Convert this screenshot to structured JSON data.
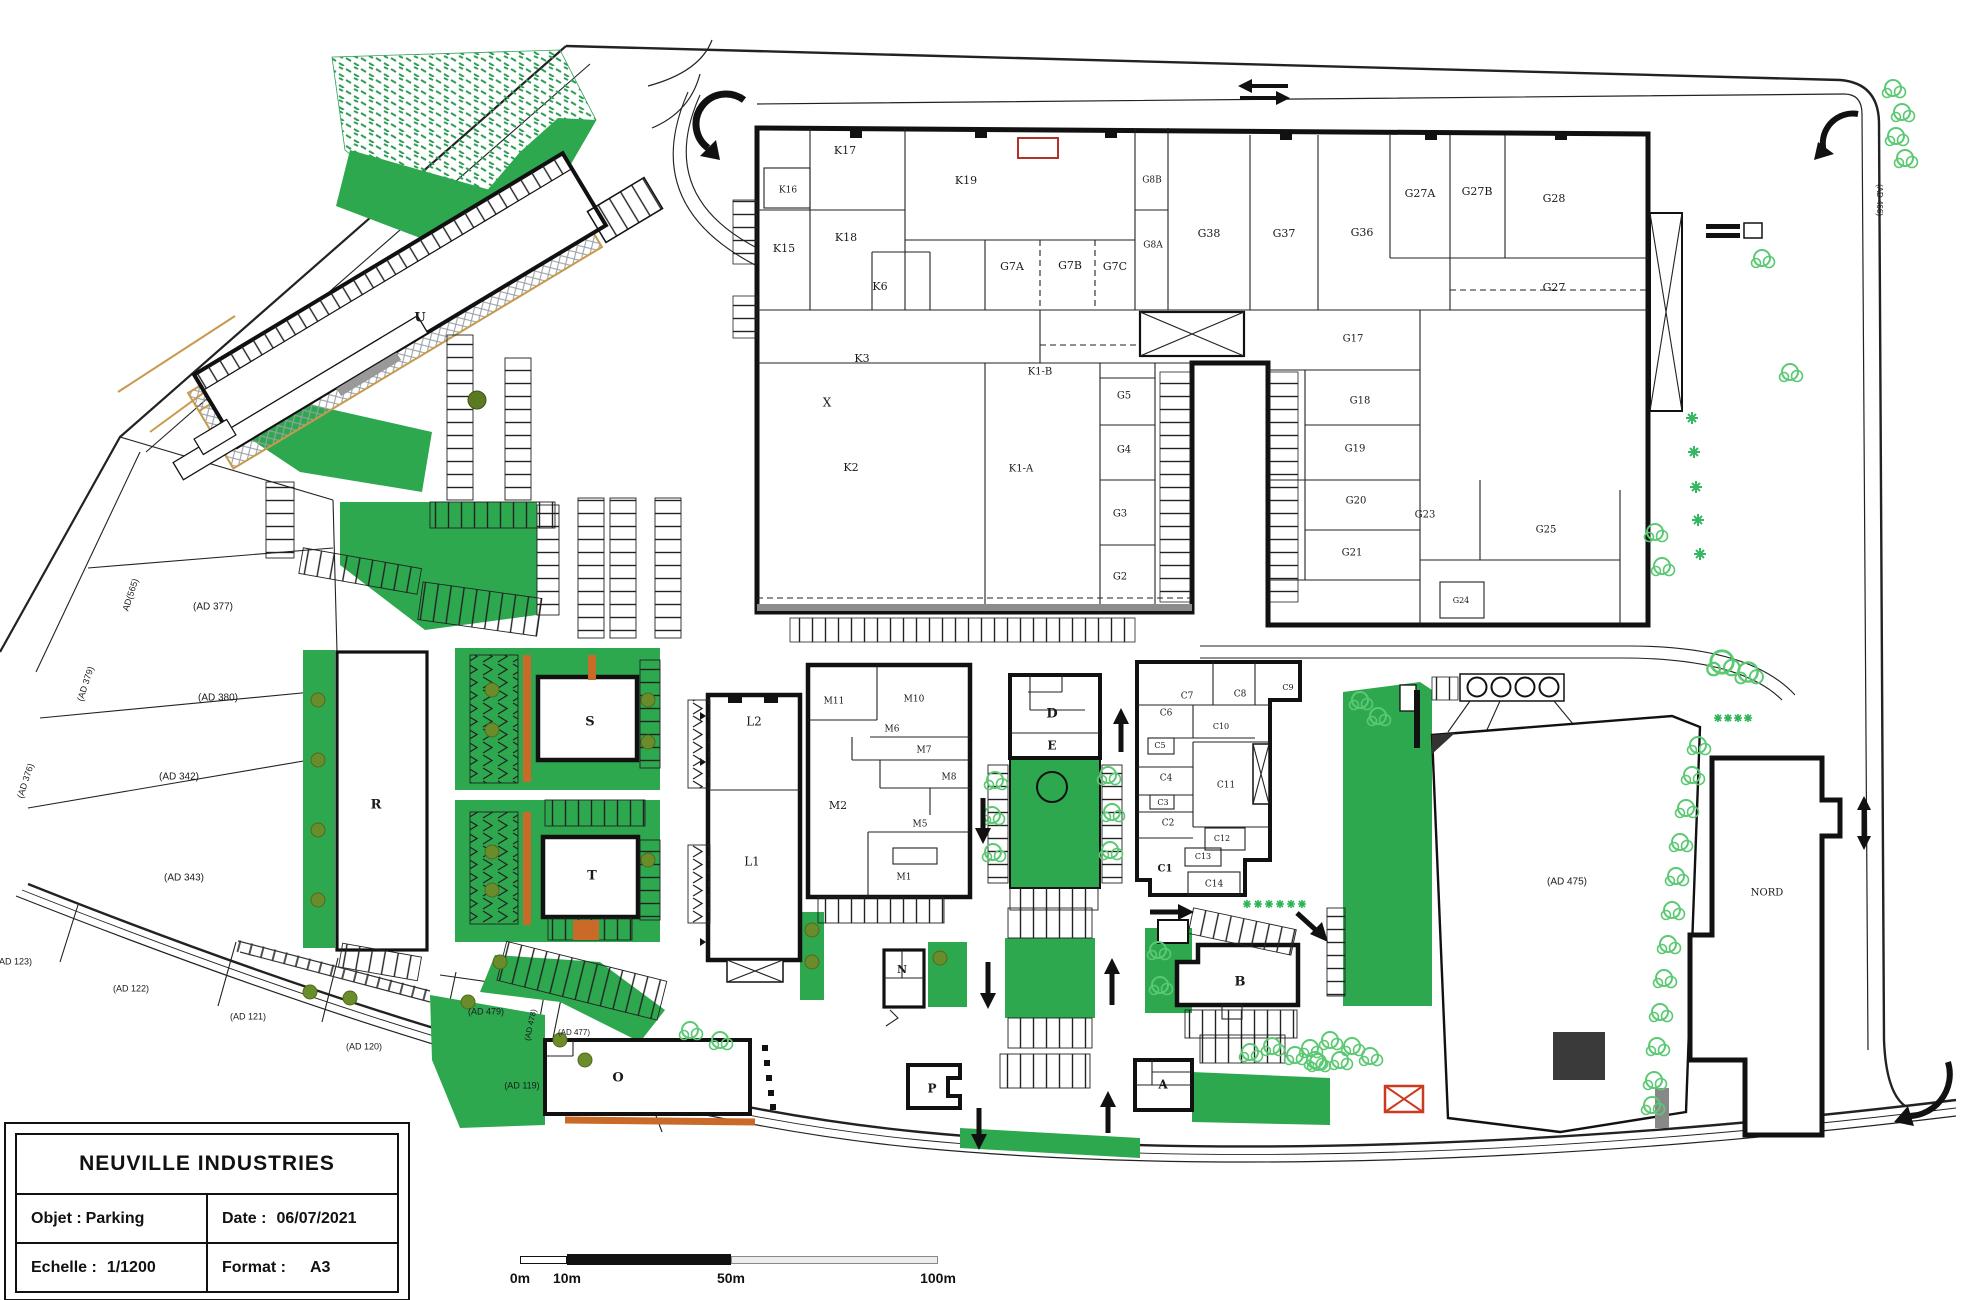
{
  "title_block": {
    "title": "NEUVILLE INDUSTRIES",
    "objet_label": "Objet :",
    "objet_value": "Parking",
    "date_label": "Date :",
    "date_value": "06/07/2021",
    "echelle_label": "Echelle :",
    "echelle_value": "1/1200",
    "format_label": "Format :",
    "format_value": "A3"
  },
  "scale_bar": {
    "labels": [
      "0m",
      "10m",
      "50m",
      "100m"
    ]
  },
  "colors": {
    "green_solid": "#2EA84F",
    "green_light": "#5bc973",
    "green_hatch": "#2f9e55",
    "olive": "#6b8c2a",
    "orange": "#c96a28",
    "tan": "#c79a4b",
    "red": "#b3322a",
    "wall": "#111111"
  },
  "plan": {
    "labels": [
      {
        "id": "k17",
        "t": "K17",
        "x": 845,
        "y": 151
      },
      {
        "id": "k16",
        "t": "K16",
        "x": 788,
        "y": 190,
        "s": 9
      },
      {
        "id": "k15",
        "t": "K15",
        "x": 784,
        "y": 249
      },
      {
        "id": "k18",
        "t": "K18",
        "x": 846,
        "y": 238
      },
      {
        "id": "k6",
        "t": "K6",
        "x": 880,
        "y": 287
      },
      {
        "id": "k19",
        "t": "K19",
        "x": 966,
        "y": 181
      },
      {
        "id": "g8b",
        "t": "G8B",
        "x": 1152,
        "y": 180,
        "s": 9
      },
      {
        "id": "g8a",
        "t": "G8A",
        "x": 1153,
        "y": 245,
        "s": 9
      },
      {
        "id": "g7a",
        "t": "G7A",
        "x": 1012,
        "y": 267
      },
      {
        "id": "g7b",
        "t": "G7B",
        "x": 1070,
        "y": 266
      },
      {
        "id": "g7c",
        "t": "G7C",
        "x": 1115,
        "y": 267
      },
      {
        "id": "g38",
        "t": "G38",
        "x": 1209,
        "y": 234
      },
      {
        "id": "g37",
        "t": "G37",
        "x": 1284,
        "y": 234
      },
      {
        "id": "g36",
        "t": "G36",
        "x": 1362,
        "y": 233
      },
      {
        "id": "g27a",
        "t": "G27A",
        "x": 1420,
        "y": 194
      },
      {
        "id": "g27b",
        "t": "G27B",
        "x": 1477,
        "y": 192
      },
      {
        "id": "g28",
        "t": "G28",
        "x": 1554,
        "y": 199
      },
      {
        "id": "g27",
        "t": "G27",
        "x": 1554,
        "y": 288
      },
      {
        "id": "k3",
        "t": "K3",
        "x": 862,
        "y": 359
      },
      {
        "id": "k1b",
        "t": "K1-B",
        "x": 1040,
        "y": 372,
        "s": 10
      },
      {
        "id": "xmark",
        "t": "X",
        "x": 827,
        "y": 403,
        "s": 12
      },
      {
        "id": "k2",
        "t": "K2",
        "x": 851,
        "y": 468
      },
      {
        "id": "k1a",
        "t": "K1-A",
        "x": 1021,
        "y": 469,
        "s": 10
      },
      {
        "id": "g5",
        "t": "G5",
        "x": 1124,
        "y": 396,
        "s": 10
      },
      {
        "id": "g4",
        "t": "G4",
        "x": 1124,
        "y": 450,
        "s": 10
      },
      {
        "id": "g3",
        "t": "G3",
        "x": 1120,
        "y": 514,
        "s": 10
      },
      {
        "id": "g2",
        "t": "G2",
        "x": 1120,
        "y": 577,
        "s": 10
      },
      {
        "id": "g17",
        "t": "G17",
        "x": 1353,
        "y": 339,
        "s": 10
      },
      {
        "id": "g18",
        "t": "G18",
        "x": 1360,
        "y": 401,
        "s": 10
      },
      {
        "id": "g19",
        "t": "G19",
        "x": 1355,
        "y": 449,
        "s": 10
      },
      {
        "id": "g20",
        "t": "G20",
        "x": 1356,
        "y": 501,
        "s": 10
      },
      {
        "id": "g21",
        "t": "G21",
        "x": 1352,
        "y": 553,
        "s": 10
      },
      {
        "id": "g23",
        "t": "G23",
        "x": 1425,
        "y": 515,
        "s": 10
      },
      {
        "id": "g25",
        "t": "G25",
        "x": 1546,
        "y": 530,
        "s": 10
      },
      {
        "id": "g24",
        "t": "G24",
        "x": 1461,
        "y": 601,
        "s": 8
      },
      {
        "id": "u",
        "t": "U",
        "x": 420,
        "y": 318,
        "s": 13,
        "b": 1
      },
      {
        "id": "r",
        "t": "R",
        "x": 376,
        "y": 805,
        "s": 13,
        "b": 1
      },
      {
        "id": "s",
        "t": "S",
        "x": 590,
        "y": 722,
        "s": 13,
        "b": 1
      },
      {
        "id": "t",
        "t": "T",
        "x": 592,
        "y": 876,
        "s": 13,
        "b": 1
      },
      {
        "id": "l2",
        "t": "L2",
        "x": 754,
        "y": 722,
        "s": 12
      },
      {
        "id": "l1",
        "t": "L1",
        "x": 752,
        "y": 862,
        "s": 12
      },
      {
        "id": "m11",
        "t": "M11",
        "x": 834,
        "y": 701,
        "s": 9
      },
      {
        "id": "m10",
        "t": "M10",
        "x": 914,
        "y": 699,
        "s": 9
      },
      {
        "id": "m6",
        "t": "M6",
        "x": 892,
        "y": 729,
        "s": 9
      },
      {
        "id": "m7",
        "t": "M7",
        "x": 924,
        "y": 750,
        "s": 9
      },
      {
        "id": "m8",
        "t": "M8",
        "x": 949,
        "y": 777,
        "s": 9
      },
      {
        "id": "m2",
        "t": "M2",
        "x": 838,
        "y": 806,
        "s": 11
      },
      {
        "id": "m5",
        "t": "M5",
        "x": 920,
        "y": 824,
        "s": 9
      },
      {
        "id": "m1",
        "t": "M1",
        "x": 904,
        "y": 877,
        "s": 9
      },
      {
        "id": "d",
        "t": "D",
        "x": 1052,
        "y": 714,
        "s": 13,
        "b": 1
      },
      {
        "id": "e",
        "t": "E",
        "x": 1052,
        "y": 746,
        "s": 12,
        "b": 1
      },
      {
        "id": "c7",
        "t": "C7",
        "x": 1187,
        "y": 696,
        "s": 9
      },
      {
        "id": "c8",
        "t": "C8",
        "x": 1240,
        "y": 694,
        "s": 9
      },
      {
        "id": "c9",
        "t": "C9",
        "x": 1288,
        "y": 688,
        "s": 8
      },
      {
        "id": "c6",
        "t": "C6",
        "x": 1166,
        "y": 713,
        "s": 9
      },
      {
        "id": "c10",
        "t": "C10",
        "x": 1221,
        "y": 727,
        "s": 8
      },
      {
        "id": "c5",
        "t": "C5",
        "x": 1160,
        "y": 746,
        "s": 8
      },
      {
        "id": "c4",
        "t": "C4",
        "x": 1166,
        "y": 778,
        "s": 9
      },
      {
        "id": "c11",
        "t": "C11",
        "x": 1226,
        "y": 785,
        "s": 9
      },
      {
        "id": "c3",
        "t": "C3",
        "x": 1163,
        "y": 803,
        "s": 8
      },
      {
        "id": "c2",
        "t": "C2",
        "x": 1168,
        "y": 823,
        "s": 9
      },
      {
        "id": "c12",
        "t": "C12",
        "x": 1222,
        "y": 839,
        "s": 8
      },
      {
        "id": "c13",
        "t": "C13",
        "x": 1203,
        "y": 857,
        "s": 8
      },
      {
        "id": "c1",
        "t": "C1",
        "x": 1165,
        "y": 869,
        "s": 10,
        "b": 1
      },
      {
        "id": "c14",
        "t": "C14",
        "x": 1214,
        "y": 884,
        "s": 9
      },
      {
        "id": "n",
        "t": "N",
        "x": 902,
        "y": 970,
        "s": 11,
        "b": 1
      },
      {
        "id": "b",
        "t": "B",
        "x": 1240,
        "y": 982,
        "s": 13,
        "b": 1
      },
      {
        "id": "p",
        "t": "P",
        "x": 932,
        "y": 1089,
        "s": 12,
        "b": 1
      },
      {
        "id": "a",
        "t": "A",
        "x": 1163,
        "y": 1085,
        "s": 12,
        "b": 1
      },
      {
        "id": "o",
        "t": "O",
        "x": 618,
        "y": 1078,
        "s": 13,
        "b": 1
      },
      {
        "id": "nord",
        "t": "NORD",
        "x": 1767,
        "y": 893,
        "s": 10
      },
      {
        "id": "ad377",
        "t": "(AD 377)",
        "x": 213,
        "y": 607,
        "s": 10,
        "f": "sans"
      },
      {
        "id": "ad380",
        "t": "(AD 380)",
        "x": 218,
        "y": 698,
        "s": 10,
        "f": "sans"
      },
      {
        "id": "ad342",
        "t": "(AD 342)",
        "x": 179,
        "y": 777,
        "s": 10,
        "f": "sans"
      },
      {
        "id": "ad343",
        "t": "(AD 343)",
        "x": 184,
        "y": 878,
        "s": 10,
        "f": "sans"
      },
      {
        "id": "ad565",
        "t": "AD(565)",
        "x": 131,
        "y": 595,
        "s": 9,
        "f": "sans",
        "r": -72
      },
      {
        "id": "ad379",
        "t": "(AD 379)",
        "x": 86,
        "y": 684,
        "s": 9,
        "f": "sans",
        "r": -72
      },
      {
        "id": "ad376",
        "t": "(AD 376)",
        "x": 26,
        "y": 781,
        "s": 9,
        "f": "sans",
        "r": -72
      },
      {
        "id": "ad123",
        "t": "(AD 123)",
        "x": 14,
        "y": 962,
        "s": 9,
        "f": "sans"
      },
      {
        "id": "ad122",
        "t": "(AD 122)",
        "x": 131,
        "y": 989,
        "s": 9,
        "f": "sans"
      },
      {
        "id": "ad121",
        "t": "(AD 121)",
        "x": 248,
        "y": 1017,
        "s": 9,
        "f": "sans"
      },
      {
        "id": "ad120",
        "t": "(AD 120)",
        "x": 364,
        "y": 1047,
        "s": 9,
        "f": "sans"
      },
      {
        "id": "ad479",
        "t": "(AD 479)",
        "x": 486,
        "y": 1012,
        "s": 9,
        "f": "sans"
      },
      {
        "id": "ad478",
        "t": "(AD 478)",
        "x": 531,
        "y": 1025,
        "s": 8,
        "f": "sans",
        "r": -78
      },
      {
        "id": "ad477",
        "t": "(AD 477)",
        "x": 574,
        "y": 1033,
        "s": 8,
        "f": "sans"
      },
      {
        "id": "ad119",
        "t": "(AD 119)",
        "x": 522,
        "y": 1086,
        "s": 9,
        "f": "sans"
      },
      {
        "id": "ad475",
        "t": "(AD 475)",
        "x": 1567,
        "y": 882,
        "s": 10,
        "f": "sans"
      },
      {
        "id": "ad466",
        "t": "(AD 466)",
        "x": 1879,
        "y": 200,
        "s": 8,
        "f": "sans",
        "r": 90
      }
    ]
  }
}
